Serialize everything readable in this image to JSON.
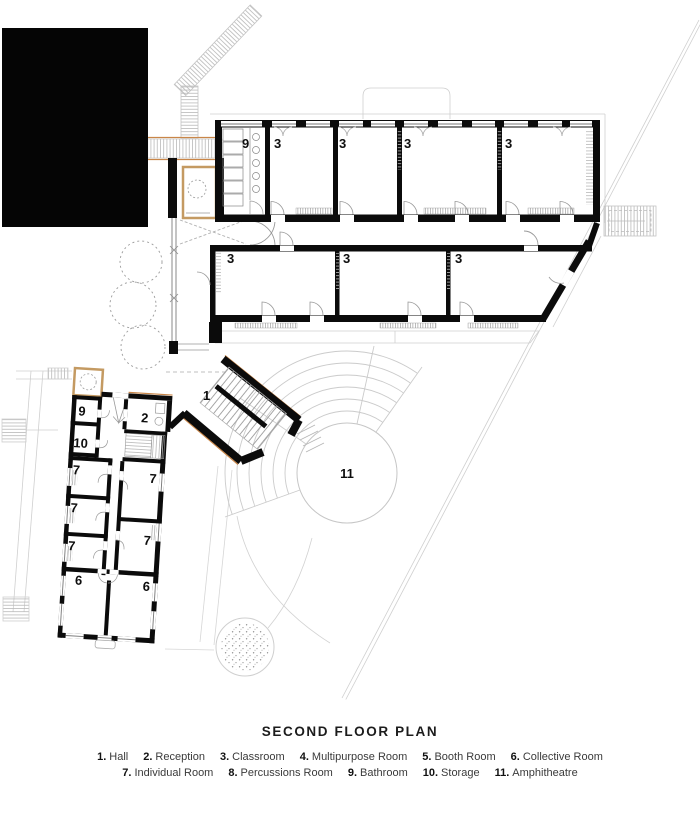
{
  "title": "SECOND FLOOR PLAN",
  "legend": {
    "items": [
      {
        "num": "1.",
        "label": "Hall"
      },
      {
        "num": "2.",
        "label": "Reception"
      },
      {
        "num": "3.",
        "label": "Classroom"
      },
      {
        "num": "4.",
        "label": "Multipurpose Room"
      },
      {
        "num": "5.",
        "label": "Booth Room"
      },
      {
        "num": "6.",
        "label": "Collective Room"
      },
      {
        "num": "7.",
        "label": "Individual Room"
      },
      {
        "num": "8.",
        "label": "Percussions Room"
      },
      {
        "num": "9.",
        "label": "Bathroom"
      },
      {
        "num": "10.",
        "label": "Storage"
      },
      {
        "num": "11.",
        "label": "Amphitheatre"
      }
    ]
  },
  "plan_labels": {
    "hall": "1",
    "reception": "2",
    "classroom": "3",
    "collective": "6",
    "individual": "7",
    "bathroom": "9",
    "storage": "10",
    "amphitheatre": "11"
  },
  "colors": {
    "wall": "#0b0b0b",
    "accent_tan": "#c98648",
    "beige_wall": "#c49a62",
    "site_line": "#cfcfcf"
  }
}
